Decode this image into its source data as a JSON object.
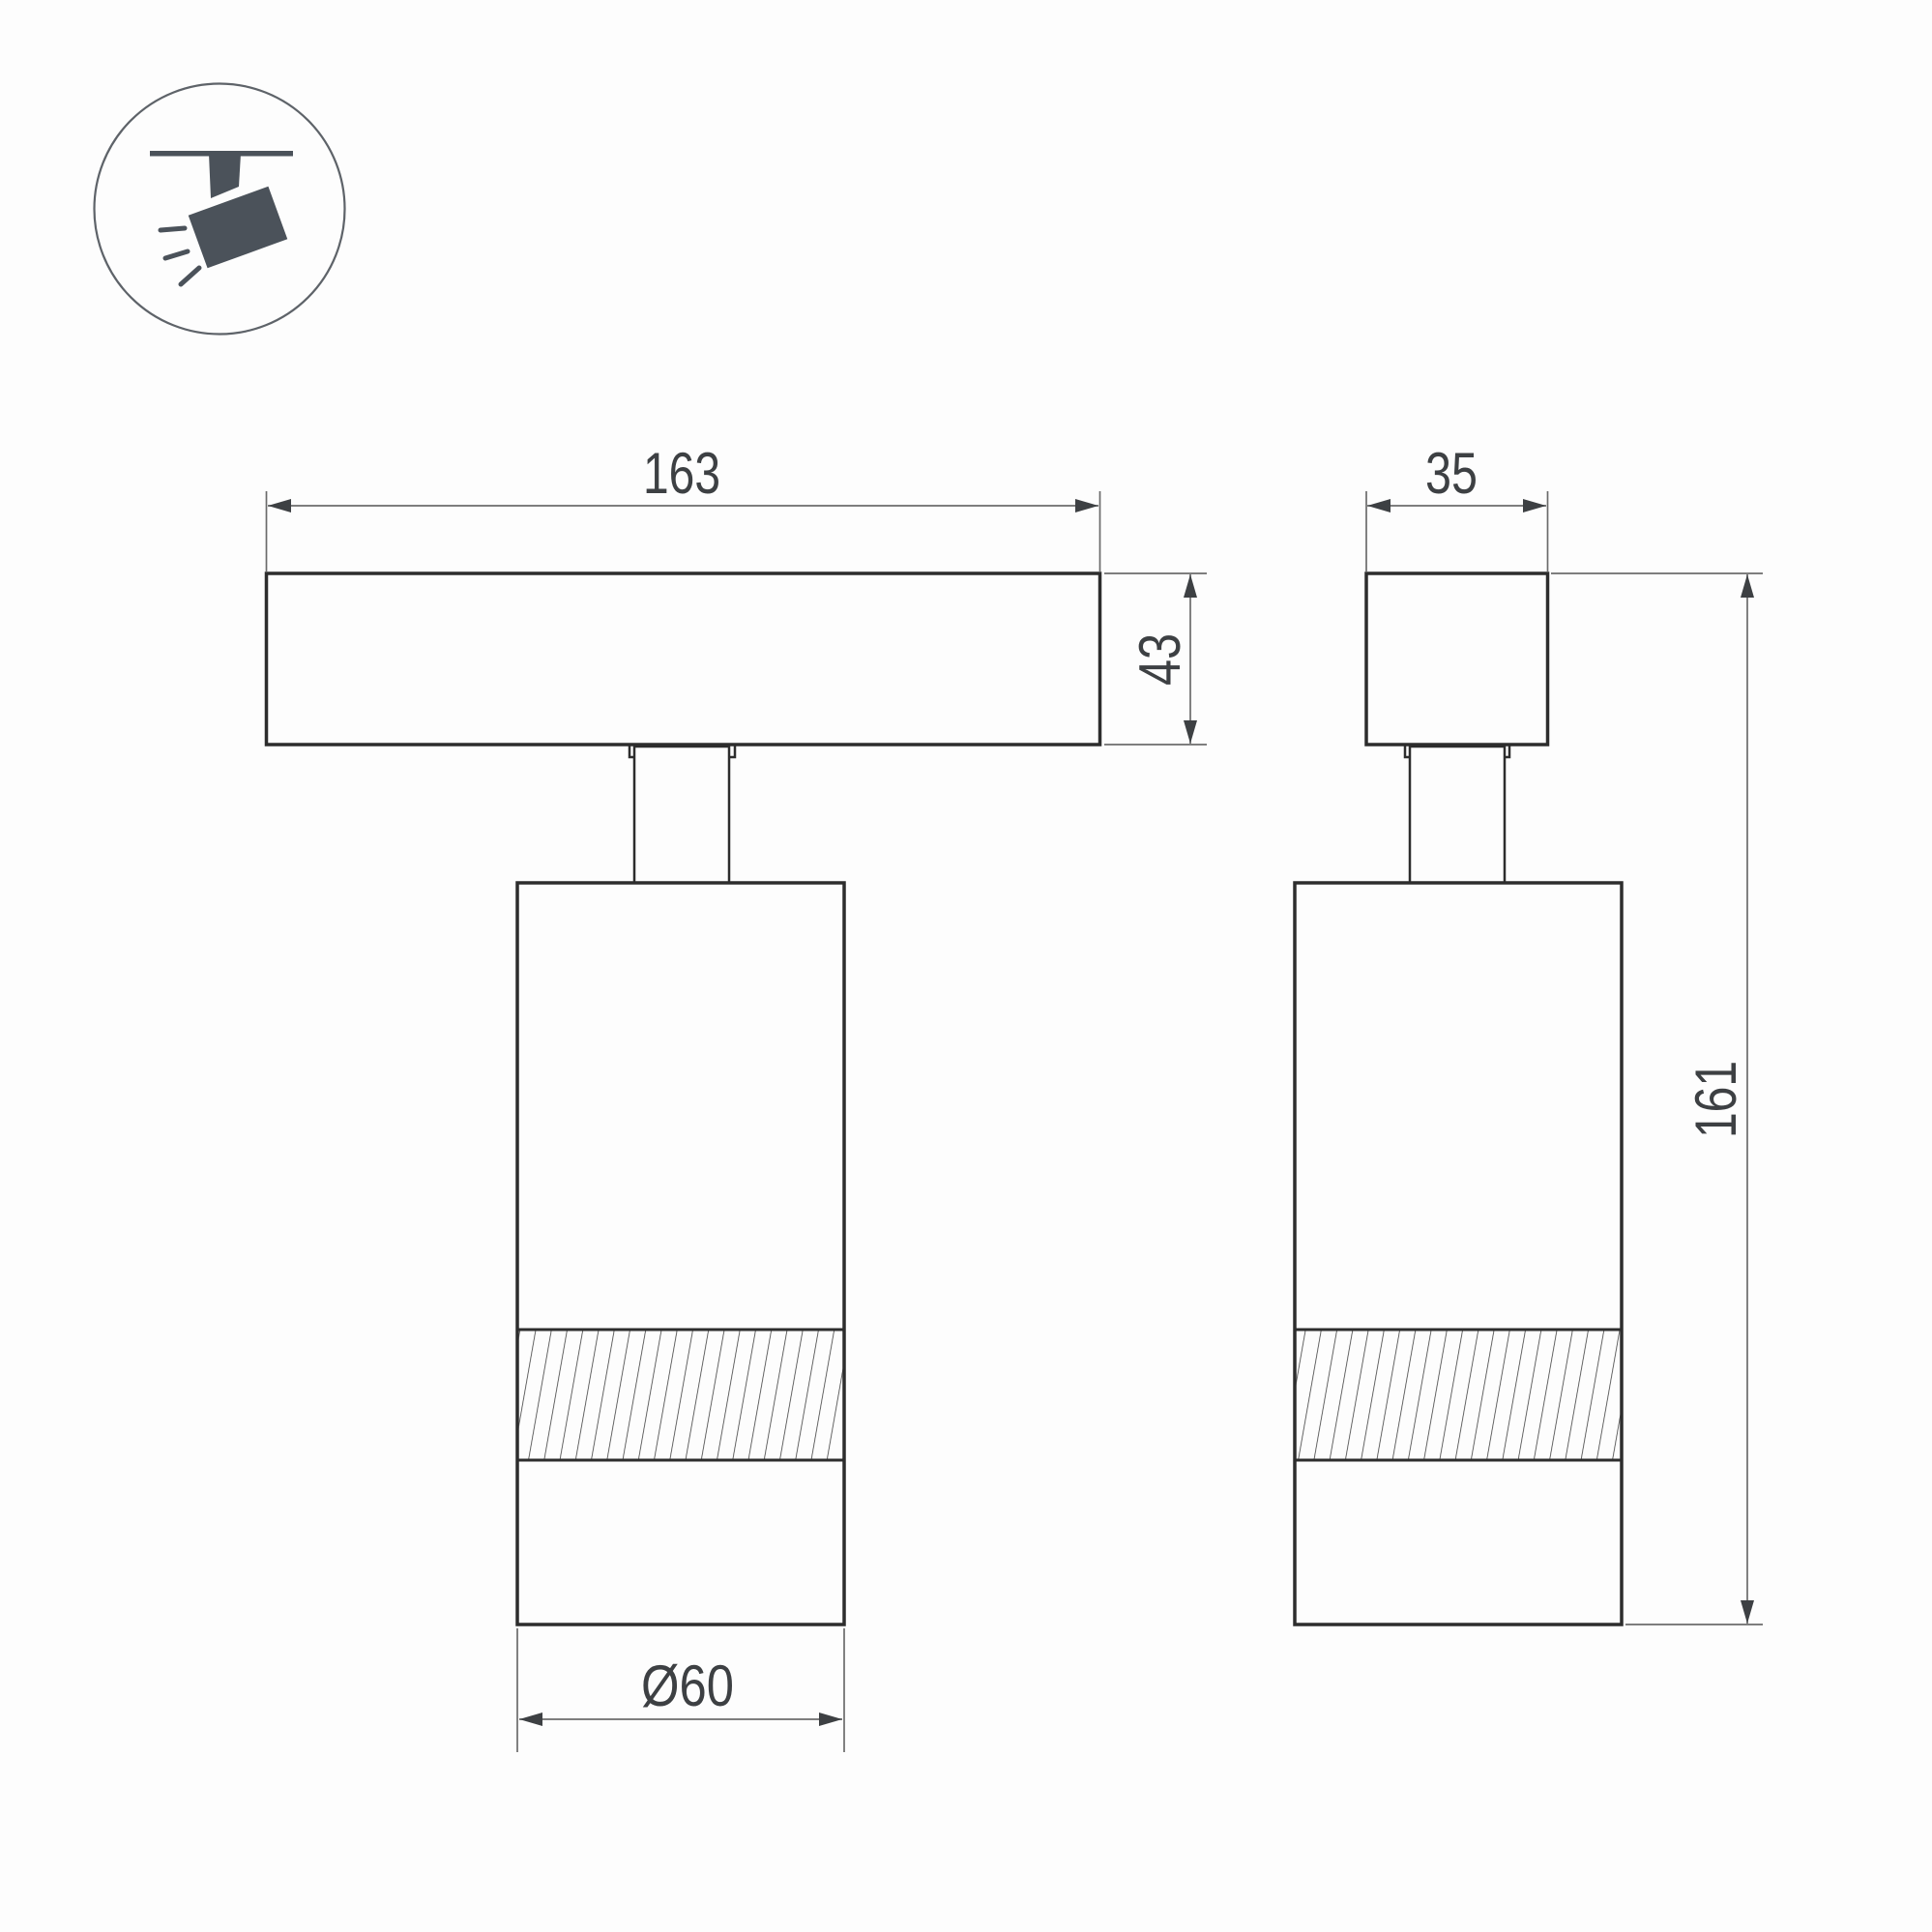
{
  "colors": {
    "outline": "#2d2d2d",
    "dimension": "#6b6b6b",
    "arrow": "#3d4043",
    "text": "#3d4043",
    "icon": "#4b525a",
    "background": "#fdfdfd"
  },
  "icon": {
    "name": "track-spotlight-icon"
  },
  "views": {
    "front": {
      "labels": {
        "width": "163",
        "track_height": "43",
        "body_diameter": "Ø60"
      }
    },
    "side": {
      "labels": {
        "width": "35",
        "total_height": "161"
      }
    }
  }
}
